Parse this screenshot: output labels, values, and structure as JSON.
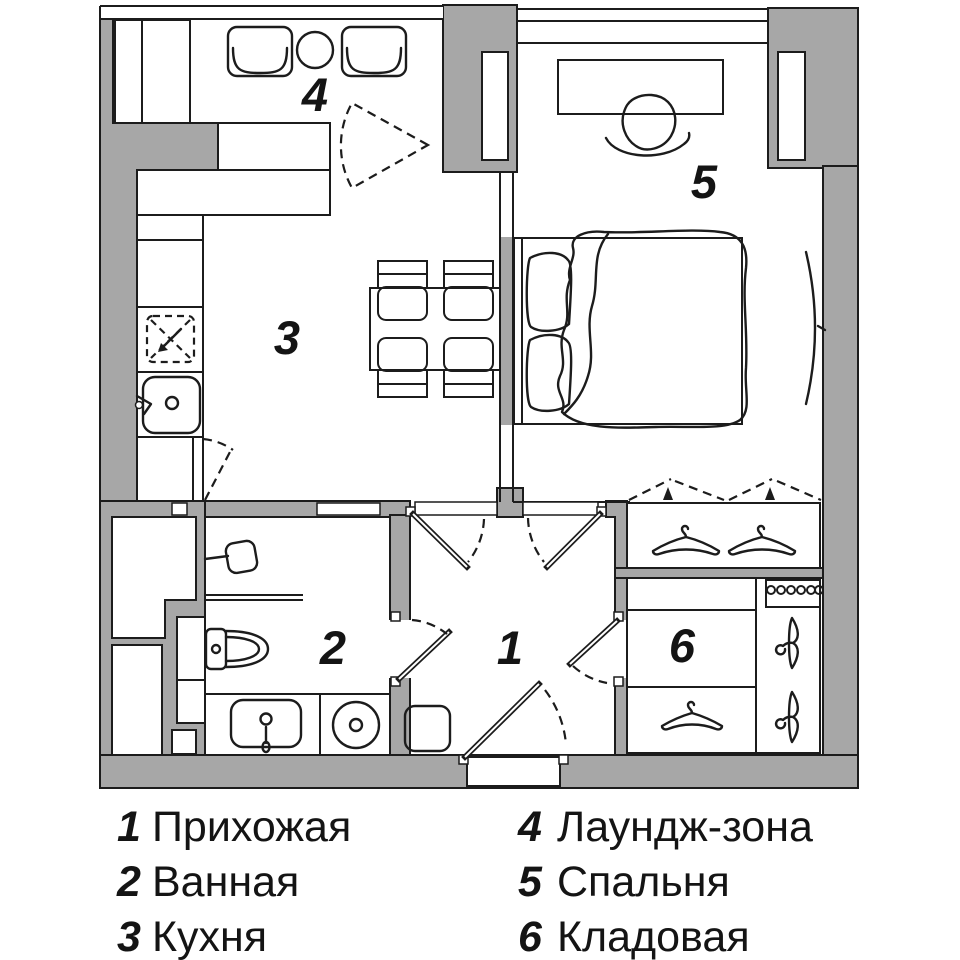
{
  "title": "Apartment floor plan",
  "colors": {
    "wall": "#a7a7a7",
    "line": "#1c1c1c",
    "floor": "#ffffff"
  },
  "rooms": [
    {
      "num": "1",
      "name": "Прихожая"
    },
    {
      "num": "2",
      "name": "Ванная"
    },
    {
      "num": "3",
      "name": "Кухня"
    },
    {
      "num": "4",
      "name": "Лаундж-зона"
    },
    {
      "num": "5",
      "name": "Спальня"
    },
    {
      "num": "6",
      "name": "Кладовая"
    }
  ]
}
